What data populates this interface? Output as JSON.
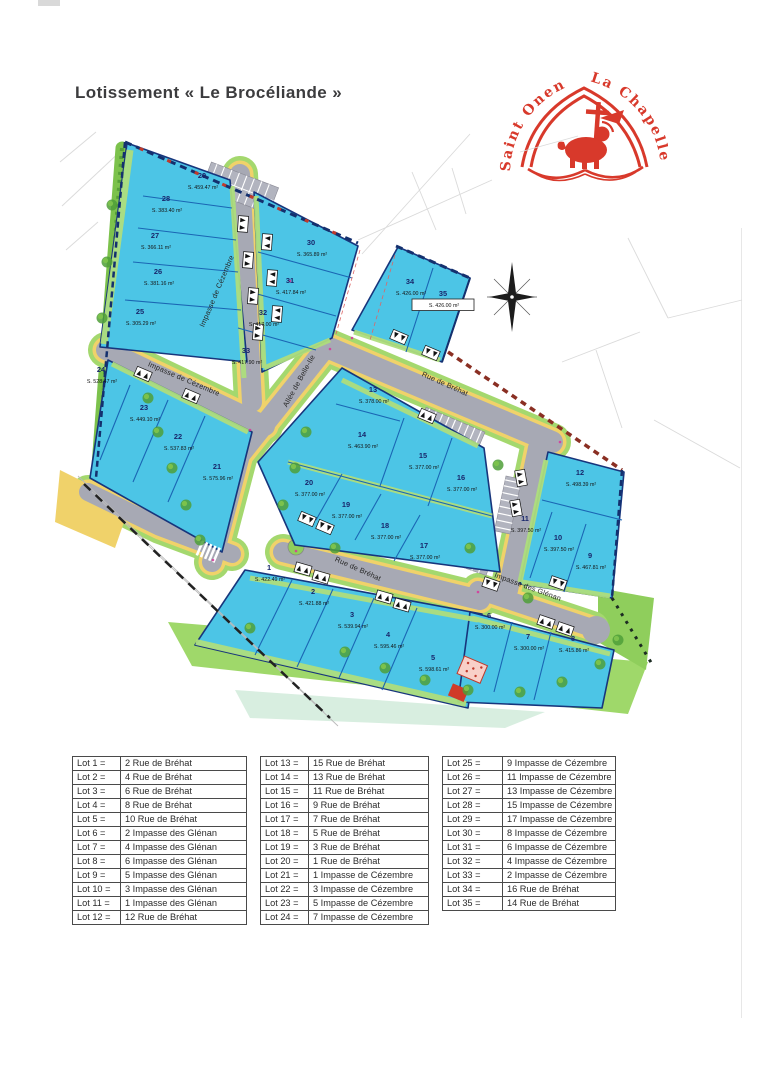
{
  "page": {
    "title": "Lotissement « Le Brocéliande »"
  },
  "logo": {
    "text_left": "Saint Onen",
    "text_right": "La Chapelle",
    "color": "#d8392b"
  },
  "map": {
    "streets": [
      {
        "name": "Impasse de Cézembre"
      },
      {
        "name": "Impasse de Cézembre"
      },
      {
        "name": "Allée de Belle-Ile"
      },
      {
        "name": "Rue de Bréhat"
      },
      {
        "name": "Rue de Bréhat"
      },
      {
        "name": "Impasse des Glénan"
      }
    ],
    "lots": [
      {
        "n": "1",
        "area": "S. 422.49 m²"
      },
      {
        "n": "2",
        "area": "S. 421.88 m²"
      },
      {
        "n": "3",
        "area": "S. 539.94 m²"
      },
      {
        "n": "4",
        "area": "S. 595.46 m²"
      },
      {
        "n": "5",
        "area": "S. 598.61 m²"
      },
      {
        "n": "6",
        "area": "S. 300.00 m²"
      },
      {
        "n": "7",
        "area": "S. 300.00 m²"
      },
      {
        "n": "8",
        "area": "S. 415.86 m²"
      },
      {
        "n": "9",
        "area": "S. 467.81 m²"
      },
      {
        "n": "10",
        "area": "S. 397.50 m²"
      },
      {
        "n": "11",
        "area": "S. 397.50 m²"
      },
      {
        "n": "12",
        "area": "S. 498.39 m²"
      },
      {
        "n": "13",
        "area": "S. 378.00 m²"
      },
      {
        "n": "14",
        "area": "S. 463.90 m²"
      },
      {
        "n": "15",
        "area": "S. 377.00 m²"
      },
      {
        "n": "16",
        "area": "S. 377.00 m²"
      },
      {
        "n": "17",
        "area": "S. 377.00 m²"
      },
      {
        "n": "18",
        "area": "S. 377.00 m²"
      },
      {
        "n": "19",
        "area": "S. 377.00 m²"
      },
      {
        "n": "20",
        "area": "S. 377.00 m²"
      },
      {
        "n": "21",
        "area": "S. 575.96 m²"
      },
      {
        "n": "22",
        "area": "S. 537.83 m²"
      },
      {
        "n": "23",
        "area": "S. 449.10 m²"
      },
      {
        "n": "24",
        "area": "S. 528.47 m²"
      },
      {
        "n": "25",
        "area": "S. 305.29 m²"
      },
      {
        "n": "26",
        "area": "S. 381.16 m²"
      },
      {
        "n": "27",
        "area": "S. 366.11 m²"
      },
      {
        "n": "28",
        "area": "S. 383.40 m²"
      },
      {
        "n": "29",
        "area": "S. 459.47 m²"
      },
      {
        "n": "30",
        "area": "S. 365.89 m²"
      },
      {
        "n": "31",
        "area": "S. 417.84 m²"
      },
      {
        "n": "32",
        "area": "S. 417.00 m²"
      },
      {
        "n": "33",
        "area": "S. 417.90 m²"
      },
      {
        "n": "34",
        "area": "S. 426.00 m²"
      },
      {
        "n": "35",
        "area": "S. 426.00 m²"
      }
    ]
  },
  "tables": [
    {
      "rows": [
        [
          "Lot 1 =",
          "2 Rue de Bréhat"
        ],
        [
          "Lot 2 =",
          "4 Rue de Bréhat"
        ],
        [
          "Lot 3 =",
          "6 Rue de Bréhat"
        ],
        [
          "Lot 4 =",
          "8 Rue de Bréhat"
        ],
        [
          "Lot 5 =",
          "10 Rue de Bréhat"
        ],
        [
          "Lot 6 =",
          "2 Impasse des Glénan"
        ],
        [
          "Lot 7 =",
          "4 Impasse des Glénan"
        ],
        [
          "Lot 8 =",
          "6 Impasse des Glénan"
        ],
        [
          "Lot 9 =",
          "5 Impasse des Glénan"
        ],
        [
          "Lot 10 =",
          "3 Impasse des Glénan"
        ],
        [
          "Lot 11 =",
          "1 Impasse des Glénan"
        ],
        [
          "Lot 12 =",
          "12 Rue de Bréhat"
        ]
      ]
    },
    {
      "rows": [
        [
          "Lot 13 =",
          "15 Rue de Bréhat"
        ],
        [
          "Lot 14 =",
          "13 Rue de Bréhat"
        ],
        [
          "Lot 15 =",
          "11 Rue de Bréhat"
        ],
        [
          "Lot 16 =",
          "9 Rue de Bréhat"
        ],
        [
          "Lot 17 =",
          "7 Rue de Bréhat"
        ],
        [
          "Lot 18 =",
          "5 Rue de Bréhat"
        ],
        [
          "Lot 19 =",
          "3 Rue de Bréhat"
        ],
        [
          "Lot 20 =",
          "1 Rue de Bréhat"
        ],
        [
          "Lot 21 =",
          "1 Impasse de Cézembre"
        ],
        [
          "Lot 22 =",
          "3 Impasse de Cézembre"
        ],
        [
          "Lot 23 =",
          "5 Impasse de Cézembre"
        ],
        [
          "Lot 24 =",
          "7 Impasse de Cézembre"
        ]
      ]
    },
    {
      "rows": [
        [
          "Lot 25 =",
          "9 Impasse de Cézembre"
        ],
        [
          "Lot 26 =",
          "11 Impasse de Cézembre"
        ],
        [
          "Lot 27 =",
          "13 Impasse de Cézembre"
        ],
        [
          "Lot 28 =",
          "15 Impasse de Cézembre"
        ],
        [
          "Lot 29 =",
          "17 Impasse de Cézembre"
        ],
        [
          "Lot 30 =",
          "8 Impasse de Cézembre"
        ],
        [
          "Lot 31 =",
          "6 Impasse de Cézembre"
        ],
        [
          "Lot 32 =",
          "4 Impasse de Cézembre"
        ],
        [
          "Lot 33 =",
          "2 Impasse de Cézembre"
        ],
        [
          "Lot 34 =",
          "16 Rue de Bréhat"
        ],
        [
          "Lot 35 =",
          "14 Rue de Bréhat"
        ]
      ]
    }
  ]
}
